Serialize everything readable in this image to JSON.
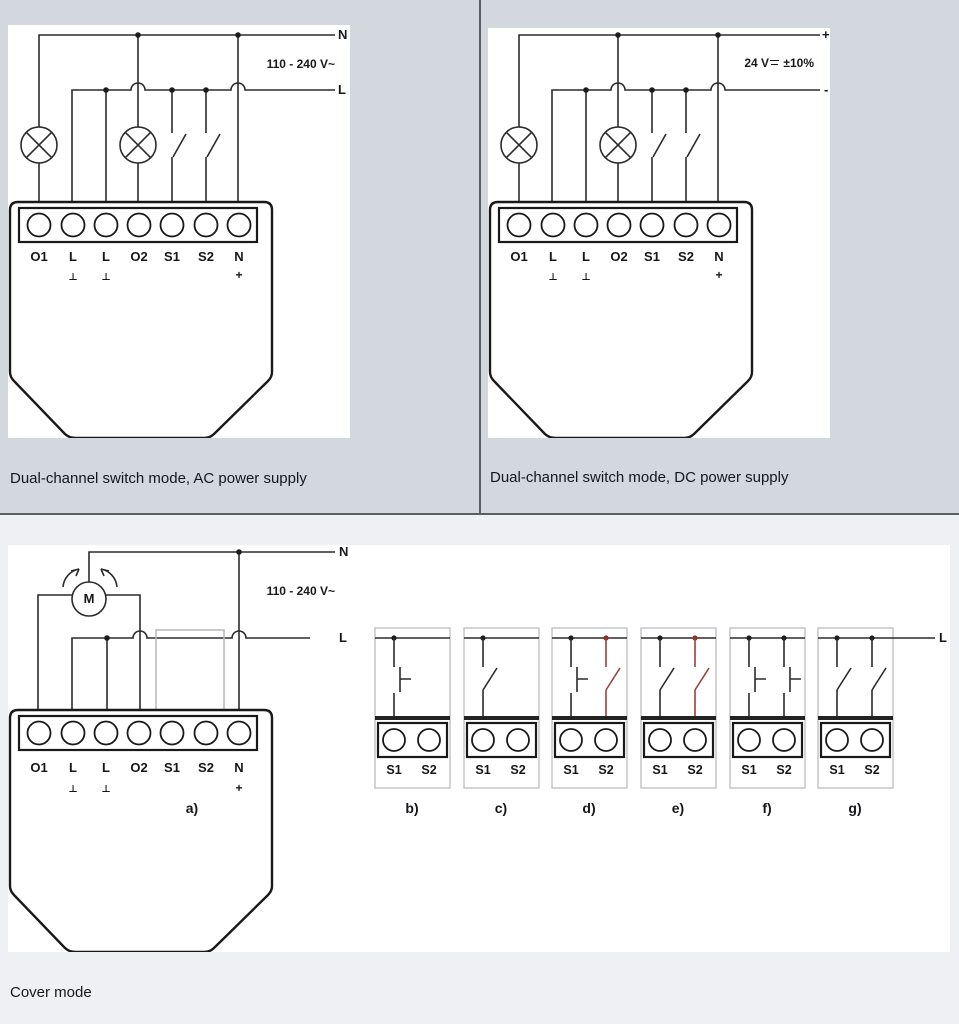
{
  "colors": {
    "background_top": "#d3d7de",
    "background_bottom": "#eef0f3",
    "panel_white": "#ffffff",
    "wire_black": "#2b2b2b",
    "wire_red": "#9c4038",
    "divider": "#5a5f66"
  },
  "device": {
    "terminals": [
      "O1",
      "L",
      "L",
      "O2",
      "S1",
      "S2",
      "N"
    ],
    "ground_symbol": "⊥",
    "plus_symbol": "+"
  },
  "ac_panel": {
    "caption": "Dual-channel switch mode, AC power supply",
    "voltage": "110 - 240 V~",
    "top_line": "N",
    "bottom_line": "L"
  },
  "dc_panel": {
    "caption": "Dual-channel switch mode, DC power supply",
    "voltage_value": "24 V",
    "voltage_tolerance": "±10%",
    "top_line": "+",
    "bottom_line": "-"
  },
  "cover_panel": {
    "caption": "Cover mode",
    "voltage": "110 - 240 V~",
    "top_line": "N",
    "bottom_line": "L",
    "right_line_label": "L",
    "motor_label": "M",
    "option_a_label": "a)",
    "sub_panels": [
      {
        "label": "b)",
        "s1": "S1",
        "s2": "S2",
        "s1_switch": "momentary",
        "s2_switch": "none"
      },
      {
        "label": "c)",
        "s1": "S1",
        "s2": "S2",
        "s1_switch": "toggle",
        "s2_switch": "none"
      },
      {
        "label": "d)",
        "s1": "S1",
        "s2": "S2",
        "s1_switch": "momentary",
        "s2_switch": "toggle-red"
      },
      {
        "label": "e)",
        "s1": "S1",
        "s2": "S2",
        "s1_switch": "toggle",
        "s2_switch": "toggle-red"
      },
      {
        "label": "f)",
        "s1": "S1",
        "s2": "S2",
        "s1_switch": "momentary",
        "s2_switch": "momentary"
      },
      {
        "label": "g)",
        "s1": "S1",
        "s2": "S2",
        "s1_switch": "toggle",
        "s2_switch": "toggle"
      }
    ]
  }
}
